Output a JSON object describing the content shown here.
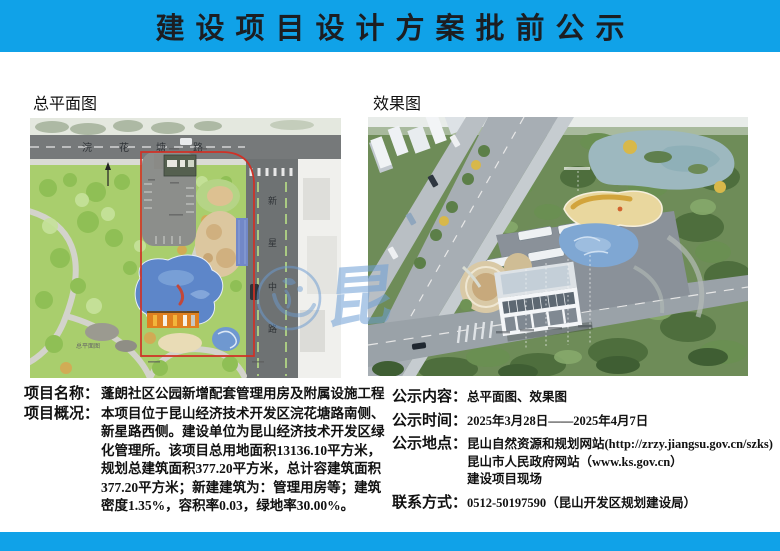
{
  "theme": {
    "accent": "#10a2e8",
    "title_color": "#1c1e22"
  },
  "header": {
    "title": "建设项目设计方案批前公示"
  },
  "figures": {
    "site_plan": {
      "label": "总平面图",
      "caption": "总平面图",
      "road_top": "浣花塘路",
      "road_right_chars": [
        "新",
        "星",
        "中",
        "路"
      ]
    },
    "rendering": {
      "label": "效果图"
    }
  },
  "watermark": {
    "char": "昆"
  },
  "left": {
    "rows": [
      {
        "label": "项目名称：",
        "lines": [
          "蓬朗社区公园新增配套管理用房及附属设施工程"
        ]
      },
      {
        "label": "项目概况：",
        "lines": [
          "本项目位于昆山经济技术开发区浣花塘路南侧、",
          "新星路西侧。建设单位为昆山经济技术开发区绿",
          "化管理所。该项目总用地面积13136.10平方米，",
          "规划总建筑面积377.20平方米，总计容建筑面积",
          "377.20平方米；新建建筑为：管理用房等；建筑",
          "密度1.35%，容积率0.03，绿地率30.00%。"
        ]
      }
    ]
  },
  "right": {
    "rows": [
      {
        "label": "公示内容：",
        "lines": [
          "总平面图、效果图"
        ]
      },
      {
        "label": "公示时间：",
        "lines": [
          "2025年3月28日——2025年4月7日"
        ]
      },
      {
        "label": "公示地点：",
        "lines": [
          "昆山自然资源和规划网站(http://zrzy.jiangsu.gov.cn/szks)",
          "昆山市人民政府网站（www.ks.gov.cn）",
          "建设项目现场"
        ]
      },
      {
        "label": "联系方式：",
        "lines": [
          "0512-50197590（昆山开发区规划建设局）"
        ]
      }
    ]
  }
}
